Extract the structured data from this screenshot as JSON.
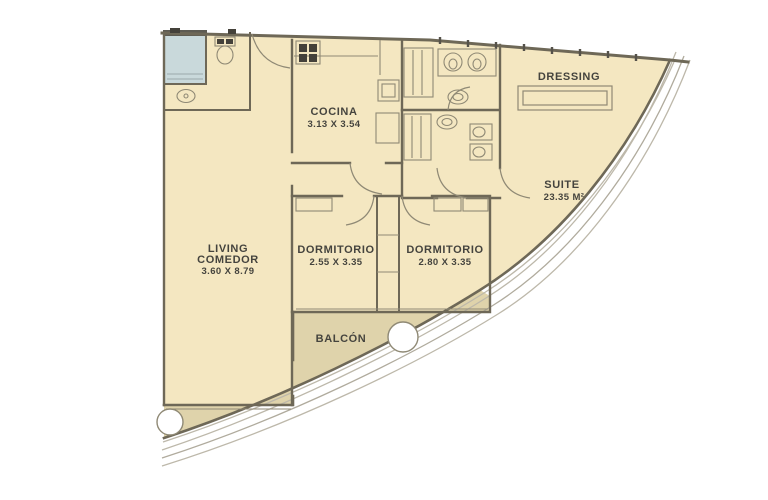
{
  "plan_title": "apartment-floor-plan",
  "rooms": {
    "living": {
      "name_line1": "LIVING",
      "name_line2": "COMEDOR",
      "dims": "3.60 X 8.79"
    },
    "cocina": {
      "name": "COCINA",
      "dims": "3.13 X 3.54"
    },
    "dormitorio1": {
      "name": "DORMITORIO",
      "dims": "2.55 X 3.35"
    },
    "dormitorio2": {
      "name": "DORMITORIO",
      "dims": "2.80 X 3.35"
    },
    "dressing": {
      "name": "DRESSING"
    },
    "suite": {
      "name": "SUITE",
      "area": "23.35 M²"
    },
    "balcon": {
      "name": "BALCÓN"
    }
  },
  "colors": {
    "room_fill": "#F4E7C1",
    "balcony_fill": "#DFD3AB",
    "wall": "#6E6857",
    "thin_line": "#8F8975",
    "shaft_fill": "#C9D9DB",
    "shaft_dark": "#5D5B52",
    "label_text": "#45443E",
    "column_fill": "#FFFFFF",
    "facade_line": "#BDB8AA",
    "fixture_dark": "#44413A"
  }
}
